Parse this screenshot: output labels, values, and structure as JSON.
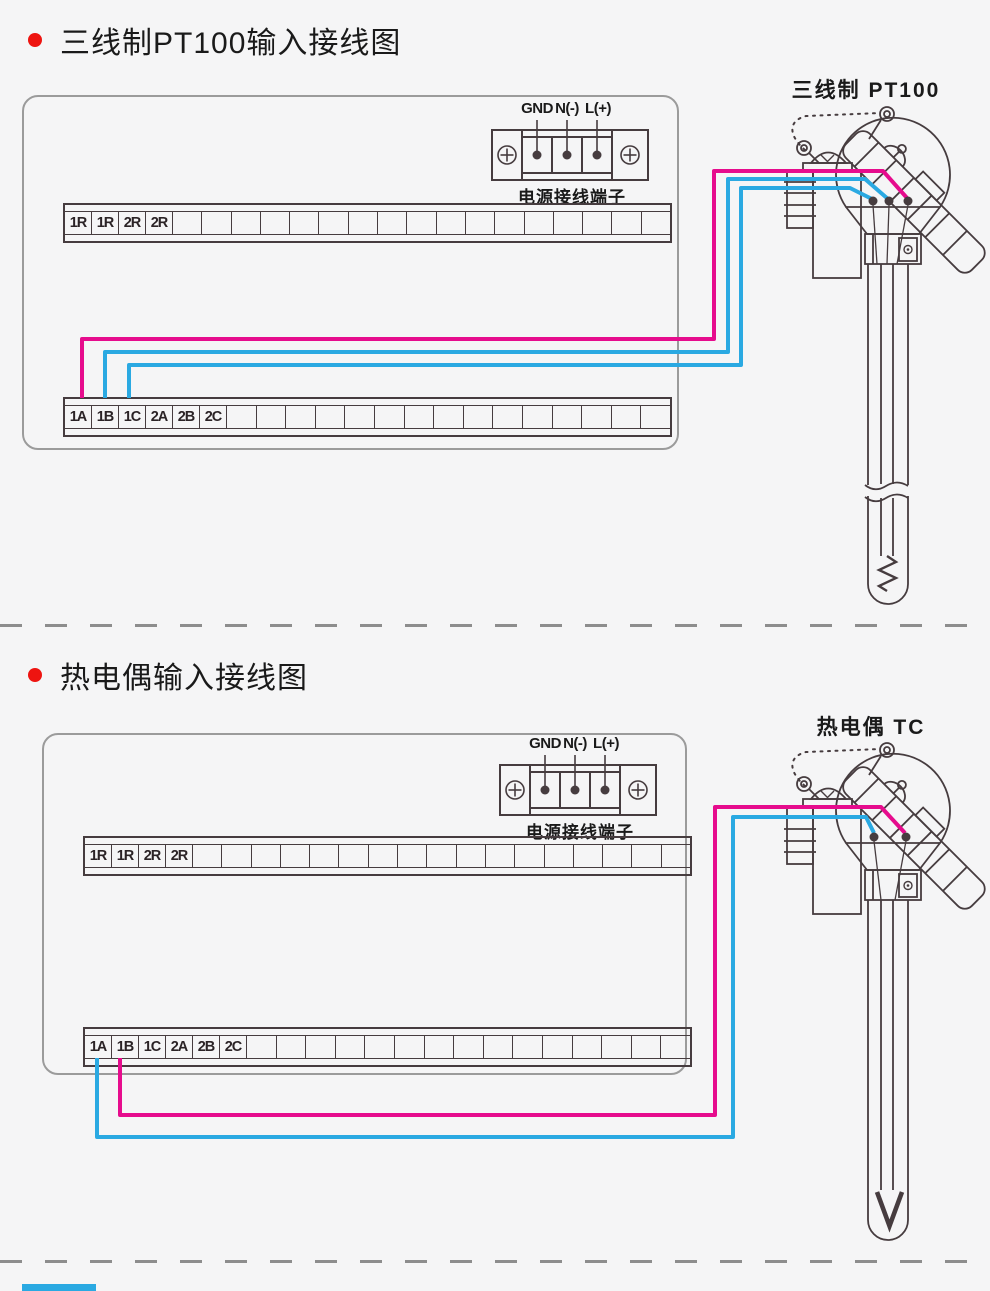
{
  "colors": {
    "background": "#f5f5f6",
    "line": "#463c3f",
    "enclosure_border": "#9b9b9b",
    "bullet_red": "#ee1410",
    "text": "#1a1a1a",
    "wire_magenta": "#e60c8d",
    "wire_blue": "#2aa9e2",
    "dash_gray": "#8d8d8d"
  },
  "sections": [
    {
      "title": "三线制PT100输入接线图",
      "sensor_label": "三线制 PT100",
      "sensor_type": "pt100",
      "power": {
        "labels": [
          "GND",
          "N(-)",
          "L(+)"
        ],
        "caption": "电源接线端子"
      },
      "strip_top": {
        "labels": [
          "1R",
          "1R",
          "2R",
          "2R"
        ],
        "empty_cells": 17
      },
      "strip_bottom": {
        "labels": [
          "1A",
          "1B",
          "1C",
          "2A",
          "2B",
          "2C"
        ],
        "empty_cells": 15
      },
      "wires": [
        {
          "from": "1A",
          "color": "magenta"
        },
        {
          "from": "1B",
          "color": "blue"
        },
        {
          "from": "1C",
          "color": "blue"
        }
      ]
    },
    {
      "title": "热电偶输入接线图",
      "sensor_label": "热电偶 TC",
      "sensor_type": "tc",
      "power": {
        "labels": [
          "GND",
          "N(-)",
          "L(+)"
        ],
        "caption": "电源接线端子"
      },
      "strip_top": {
        "labels": [
          "1R",
          "1R",
          "2R",
          "2R"
        ],
        "empty_cells": 17
      },
      "strip_bottom": {
        "labels": [
          "1A",
          "1B",
          "1C",
          "2A",
          "2B",
          "2C"
        ],
        "empty_cells": 15
      },
      "wires": [
        {
          "from": "1A",
          "color": "blue"
        },
        {
          "from": "1B",
          "color": "magenta"
        }
      ]
    }
  ]
}
